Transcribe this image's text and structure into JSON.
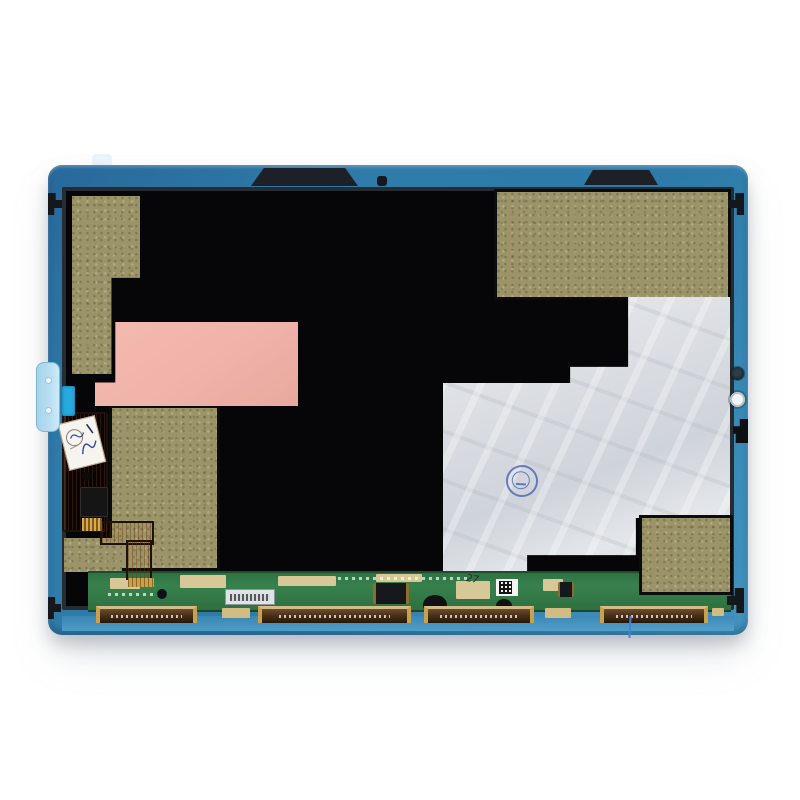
{
  "scene": {
    "type": "product-photo",
    "subject": "Tablet LCD display assembly, rear view, on white background",
    "background": "#ffffff"
  },
  "device": {
    "frame_color": "#2f7ba9",
    "panel_color": "#060609",
    "panel_rim": "#272c33",
    "adhesive_color": "#9b9468",
    "pink_sticker": "#efb3a9",
    "foil_color": "#dadde2",
    "pcb_color": "#37814d",
    "flex_color": "#cd7420",
    "connector_color": "#4a3118",
    "gold_color": "#c9a14c",
    "pull_tab_color": "#b9def1",
    "accent_tab_color": "#27a9dd",
    "stamp_color": "#3c55b5"
  },
  "markings": {
    "pcb_handwritten_number": "27"
  }
}
